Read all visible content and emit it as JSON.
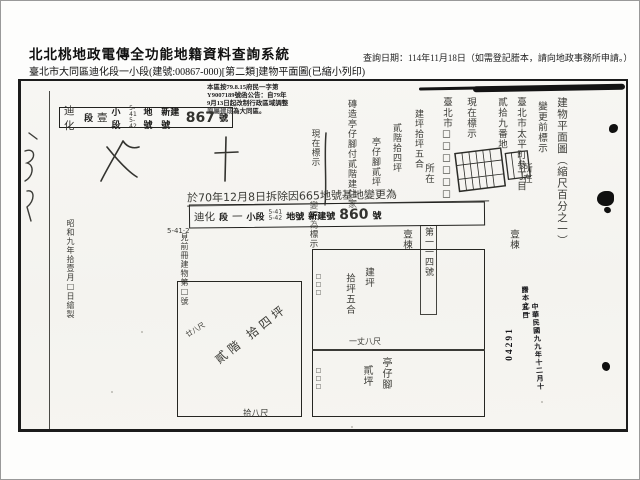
{
  "header": {
    "system_title": "北北桃地政電傳全功能地籍資料查詢系統",
    "query_date": "查詢日期：114年11月18日（如需登記謄本，請向地政事務所申請。）",
    "document_line": "臺北市大同區迪化段一小段(建號:00867-000)[第二類]建物平面圖(已縮小列印)"
  },
  "scan": {
    "notice_lines": {
      "l1": "本區按79.8.15府民一字第",
      "l2": "Y9007189號函公告：自79年",
      "l3": "9月13日起改制行政區域調整",
      "l4": "原屬建成為大同區。"
    },
    "stamp_box_top": {
      "p0": "迪化",
      "p1": "段",
      "p2": "壹",
      "p3": "小段",
      "p4": "5-41\n5-42",
      "p5": "地號",
      "p6": "新建號",
      "p7": "867",
      "p8": "號"
    },
    "note_line": "於70年12月8日拆除因665地號基地變更為",
    "stamp_box_bottom": {
      "p0": "迪化",
      "p1": "段",
      "p2": "一",
      "p3": "小段",
      "p4": "5-41\n5-42",
      "p5": "地號",
      "p6": "新建號",
      "p7": "860",
      "p8": "號"
    },
    "sub_note": "5-41·2",
    "annotations": {
      "a1": "建物平面圖（縮尺百分之一）",
      "a2": "變更前標示",
      "a3": "臺北市太平町參丁目",
      "a4": "貳拾九番地",
      "a5": "所在",
      "a6": "壹棟",
      "a7": "現在標示",
      "a8": "臺北市□□□□□□",
      "a9": "所在",
      "a10": "磚造亭仔腳付貳階建住家",
      "a11": "建坪拾坪五合",
      "a12": "貳階拾四坪",
      "a13": "亭仔腳貳坪",
      "a14": "壹棟",
      "a15": "第一一四號",
      "a16": "變更為標示",
      "a17": "現在標示",
      "a18": "見前冊建物第□號",
      "a19": "昭和九年拾壹月□日繪製"
    },
    "plan": {
      "left_room_label": "貳階 拾四坪",
      "left_room_bottom": "拾八尺",
      "left_room_side": "廿八尺",
      "right_top_label_a": "建坪",
      "right_top_label_b": "拾坪五合",
      "divider_label": "一丈八尺",
      "right_bottom_label_a": "亭仔腳",
      "right_bottom_label_b": "貳坪",
      "edge_small_1": "□□□",
      "edge_small_2": "□□□"
    },
    "receipt_stamp": {
      "label": "謄本之一",
      "date": "中華民國九九年十二月十五日",
      "serial": "04291"
    }
  }
}
